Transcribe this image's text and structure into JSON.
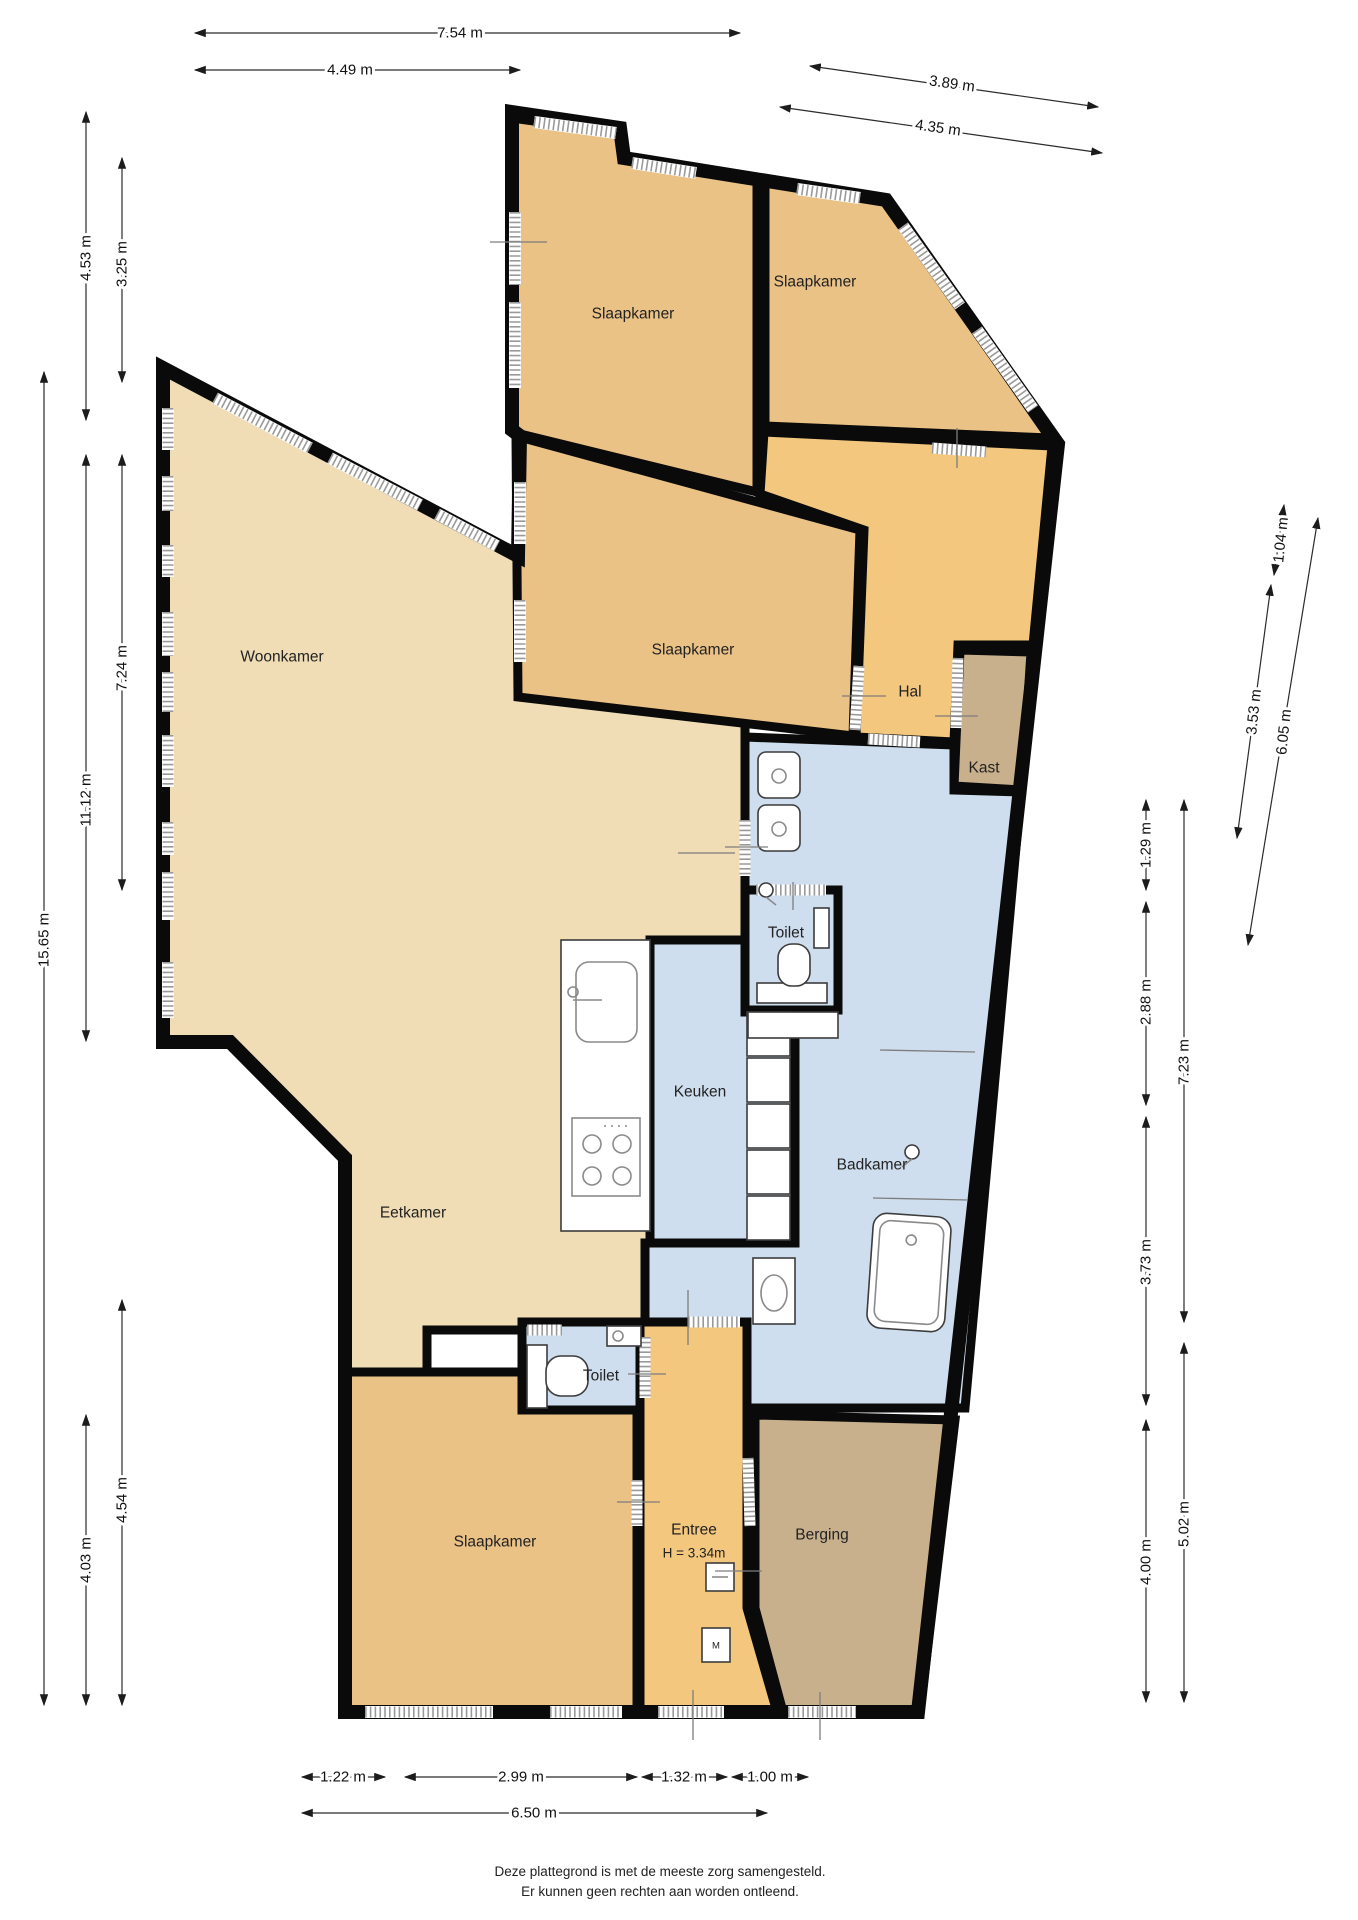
{
  "title": "Plattegrond",
  "rooms": {
    "slaapkamer_tl": "Slaapkamer",
    "slaapkamer_tr": "Slaapkamer",
    "slaapkamer_mid": "Slaapkamer",
    "hal": "Hal",
    "kast": "Kast",
    "woonkamer": "Woonkamer",
    "toilet_boven": "Toilet",
    "keuken": "Keuken",
    "badkamer": "Badkamer",
    "eetkamer": "Eetkamer",
    "toilet_onder": "Toilet",
    "slaapkamer_onder": "Slaapkamer",
    "entree": "Entree",
    "entree_hoogte": "H = 3.34m",
    "berging": "Berging",
    "meterkast": "M"
  },
  "dimensions": {
    "top": {
      "d754": "7.54 m",
      "d449": "4.49 m",
      "d389": "3.89 m",
      "d435": "4.35 m"
    },
    "left": {
      "d453": "4.53 m",
      "d325": "3.25 m",
      "d1565": "15.65 m",
      "d1112": "11.12 m",
      "d724": "7.24 m",
      "d403": "4.03 m",
      "d454": "4.54 m"
    },
    "right": {
      "d104": "1.04 m",
      "d353": "3.53 m",
      "d605": "6.05 m",
      "d129": "1.29 m",
      "d288": "2.88 m",
      "d723": "7.23 m",
      "d373": "3.73 m",
      "d400": "4.00 m",
      "d502": "5.02 m"
    },
    "bottom": {
      "d122": "1.22 m",
      "d299": "2.99 m",
      "d132": "1.32 m",
      "d100": "1.00 m",
      "d650": "6.50 m"
    }
  },
  "footer": {
    "line1": "Deze plattegrond is met de meeste zorg samengesteld.",
    "line2": "Er kunnen geen rechten aan worden ontleend."
  },
  "colors": {
    "wall": "#0a0a0a",
    "floor_living": "#f0ddb6",
    "floor_bedroom": "#ebc286",
    "floor_hall": "#f3c77d",
    "floor_wet": "#cfdeee",
    "floor_storage": "#c9b08d"
  }
}
